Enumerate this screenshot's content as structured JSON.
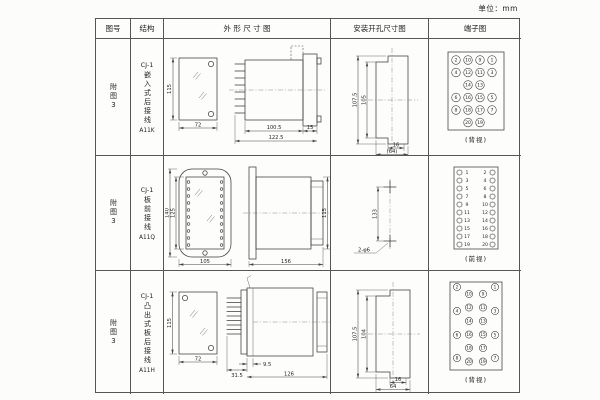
{
  "unit_label": "单位：mm",
  "headers": {
    "fig": "图号",
    "structure": "结构",
    "outline": "外 形 尺 寸 图",
    "mounting": "安装开孔尺寸图",
    "terminal": "端子图"
  },
  "rows": [
    {
      "fig": "附图3",
      "model": "CJ-1",
      "desc": "嵌入式后接线",
      "code": "A11K",
      "dims": {
        "front_h": "115",
        "front_w": "72",
        "body_len": "100.5",
        "total_len": "122.5",
        "flange_w": "15",
        "cut_outer_h": "107.5",
        "cut_inner_h": "105",
        "cut_slot_w": "16",
        "cut_total_w": "(64)"
      },
      "terminal": {
        "view": "(背视)",
        "grid": [
          [
            "2",
            "10",
            "9",
            "1"
          ],
          [
            "4",
            "12",
            "11",
            "3"
          ],
          [
            "14",
            "13"
          ],
          [
            "6",
            "16",
            "15",
            "5"
          ],
          [
            "8",
            "18",
            "17",
            "7"
          ],
          [
            "20",
            "19"
          ]
        ]
      }
    },
    {
      "fig": "附图3",
      "model": "CJ-1",
      "desc": "板前接线",
      "code": "A11Q",
      "dims": {
        "front_outer_h": "140",
        "front_inner_h": "125",
        "front_w": "105",
        "body_len": "156",
        "body_h": "115",
        "hole_pitch": "133",
        "hole_note": "2-φ6"
      },
      "terminal": {
        "view": "(前视)",
        "left": [
          "1",
          "3",
          "5",
          "7",
          "9",
          "11",
          "13",
          "15",
          "17",
          "19"
        ],
        "right": [
          "2",
          "4",
          "6",
          "8",
          "10",
          "12",
          "14",
          "16",
          "18",
          "20"
        ]
      }
    },
    {
      "fig": "附图3",
      "model": "CJ-1",
      "desc": "凸出式板后接线",
      "code": "A11H",
      "dims": {
        "front_h": "115",
        "front_w": "72",
        "pin_len": "31.5",
        "step_len": "9.5",
        "body_len": "126",
        "cut_outer_h": "107.5",
        "cut_inner_h": "104",
        "cut_slot_w": "16",
        "cut_total_w": "64"
      },
      "terminal": {
        "view": "(背视)",
        "outer_left": [
          "2",
          "4",
          "6",
          "8"
        ],
        "inner_left": [
          "10",
          "12",
          "14",
          "16",
          "18",
          "20"
        ],
        "inner_right": [
          "9",
          "11",
          "13",
          "15",
          "17",
          "19"
        ],
        "outer_right": [
          "1",
          "3",
          "5",
          "7"
        ]
      }
    }
  ]
}
